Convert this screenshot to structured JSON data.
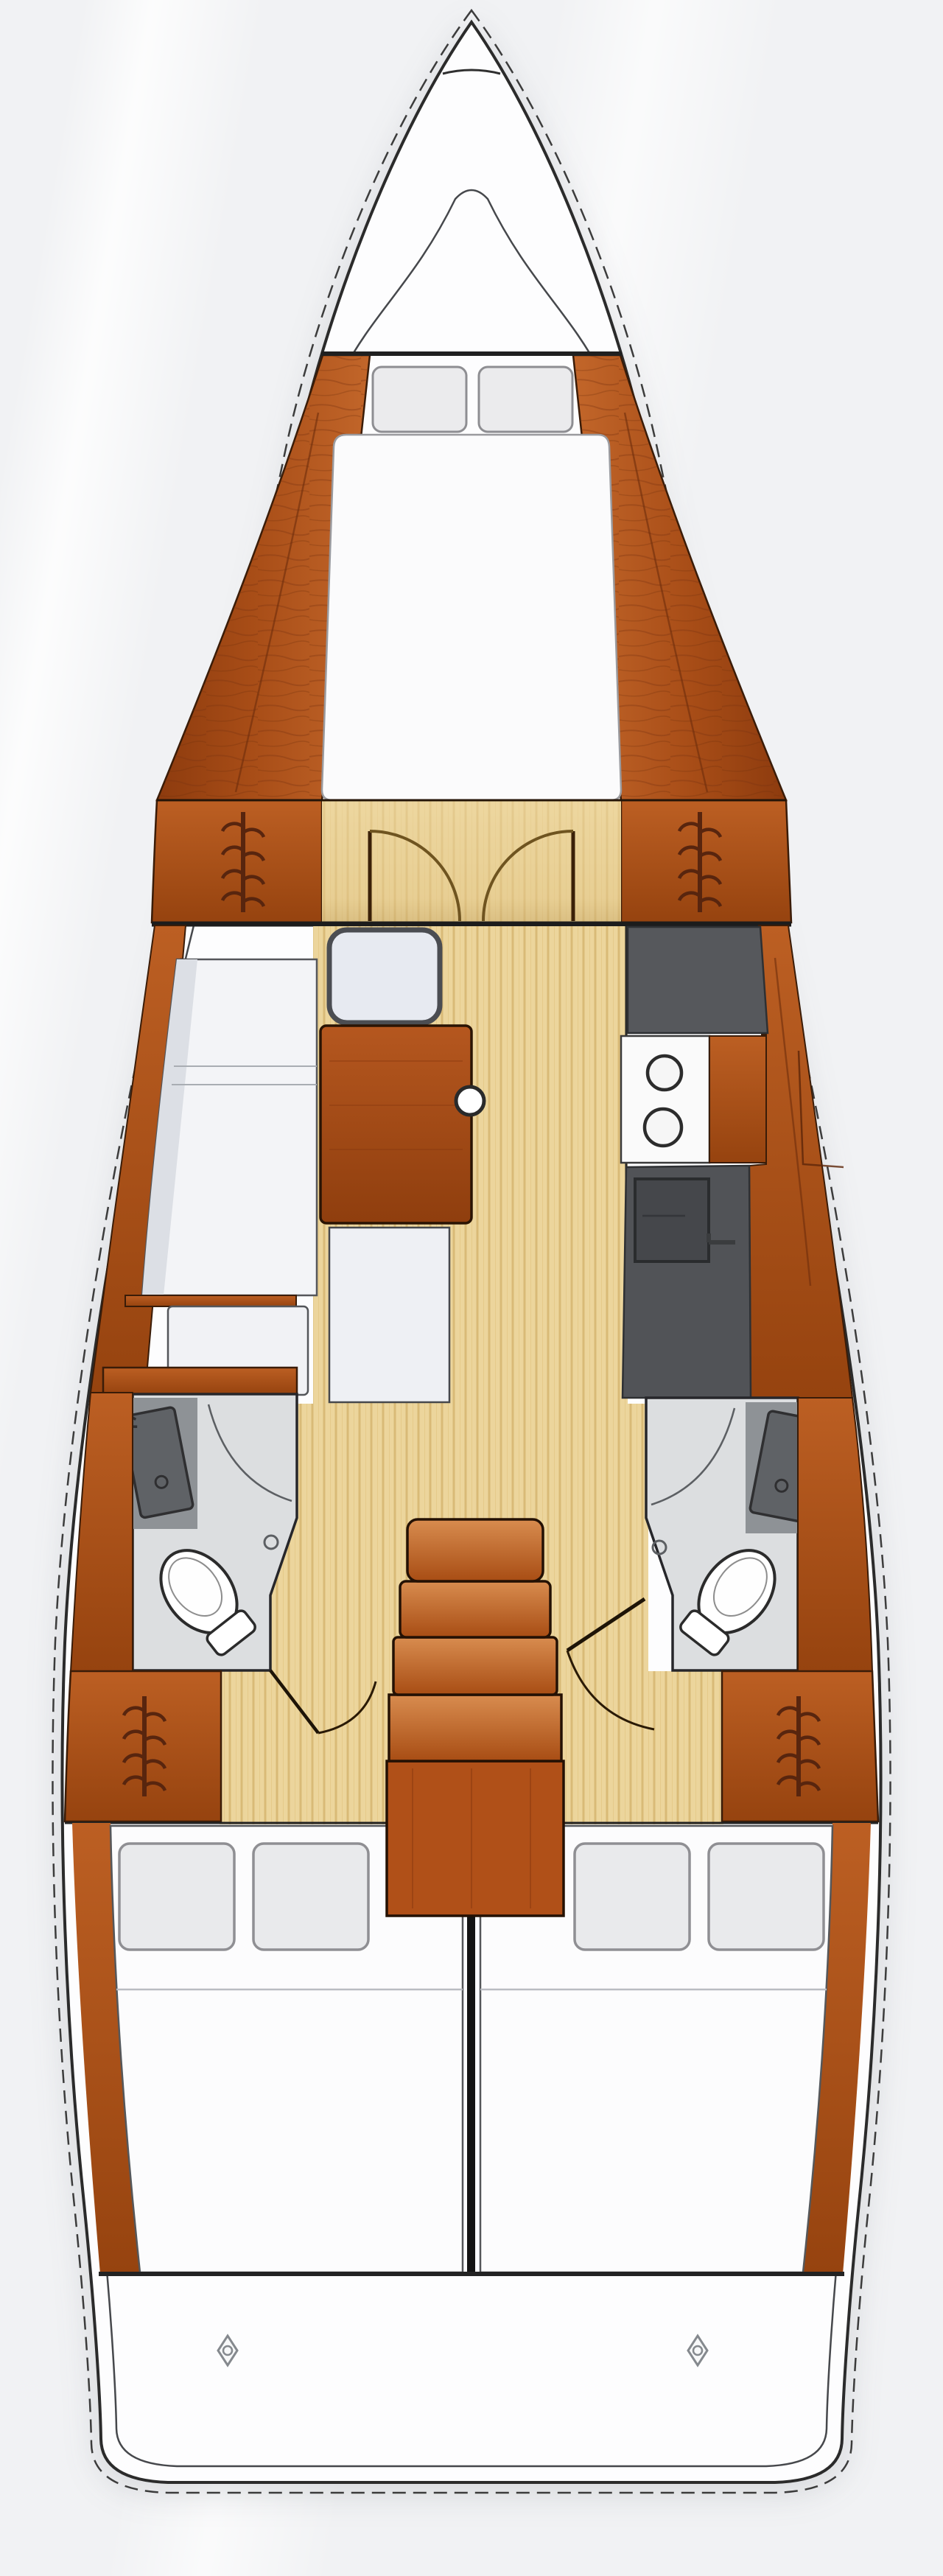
{
  "meta": {
    "type": "boat-floor-plan",
    "view": "top-down interior layout of a sailing yacht hull",
    "orientation": "bow at top, stern at bottom"
  },
  "palette": {
    "background": "#f1f2f4",
    "deck_white": "#fdfdfe",
    "hull_outline": "#2b2b2b",
    "inner_hull_line": "#46484c",
    "wood_light": "#c2662a",
    "wood_dark": "#8d3b0e",
    "wood_outline": "#2a1404",
    "floor_tan": "#ecd59c",
    "floor_stripe": "#d9ba77",
    "counter_gray": "#56585c",
    "sink_gray": "#45474b",
    "head_floor_gray": "#dcdee0",
    "fixture_white": "#ffffff",
    "cushion_white": "#f3f4f7",
    "pillow_gray": "#ebebed",
    "divider_black": "#141414"
  },
  "compartments": [
    {
      "name": "bow",
      "features": [
        "anchor-locker-line"
      ]
    },
    {
      "name": "forward-cabin",
      "features": [
        "v-berth-mattress",
        "pillow x2",
        "wood-side-panels",
        "hanging-locker-icon x2",
        "double-doors-with-swing-arcs"
      ]
    },
    {
      "name": "saloon",
      "features": [
        "l-shaped-settee",
        "chart-seat",
        "wood-table",
        "table-knob",
        "corner-seat"
      ]
    },
    {
      "name": "galley",
      "features": [
        "counter-top",
        "stove-with-two-burners",
        "sink",
        "faucet-icon"
      ]
    },
    {
      "name": "port-head",
      "features": [
        "vanity-sink-tilted",
        "shower-curtain-arc",
        "shower-drain",
        "toilet",
        "door-swing-arc"
      ]
    },
    {
      "name": "starboard-head",
      "features": [
        "vanity-sink-tilted",
        "shower-curtain-arc",
        "shower-drain",
        "toilet",
        "open-door-with-swing-arc"
      ]
    },
    {
      "name": "companionway",
      "features": [
        "stairs-4-steps",
        "landing-platform"
      ]
    },
    {
      "name": "aft-cabin-port",
      "features": [
        "double-berth",
        "pillow x2",
        "hanging-locker-icon"
      ]
    },
    {
      "name": "aft-cabin-starboard",
      "features": [
        "double-berth",
        "pillow x2",
        "hanging-locker-icon"
      ]
    },
    {
      "name": "transom",
      "features": [
        "deck-fitting-diamond x2",
        "stern-bench-line"
      ]
    }
  ],
  "icons": {
    "hanging_locker": "hanger-rail-fishbone-icon",
    "burner": "stove-burner-circle-icon",
    "deck_fitting": "diamond-with-circle-icon"
  }
}
